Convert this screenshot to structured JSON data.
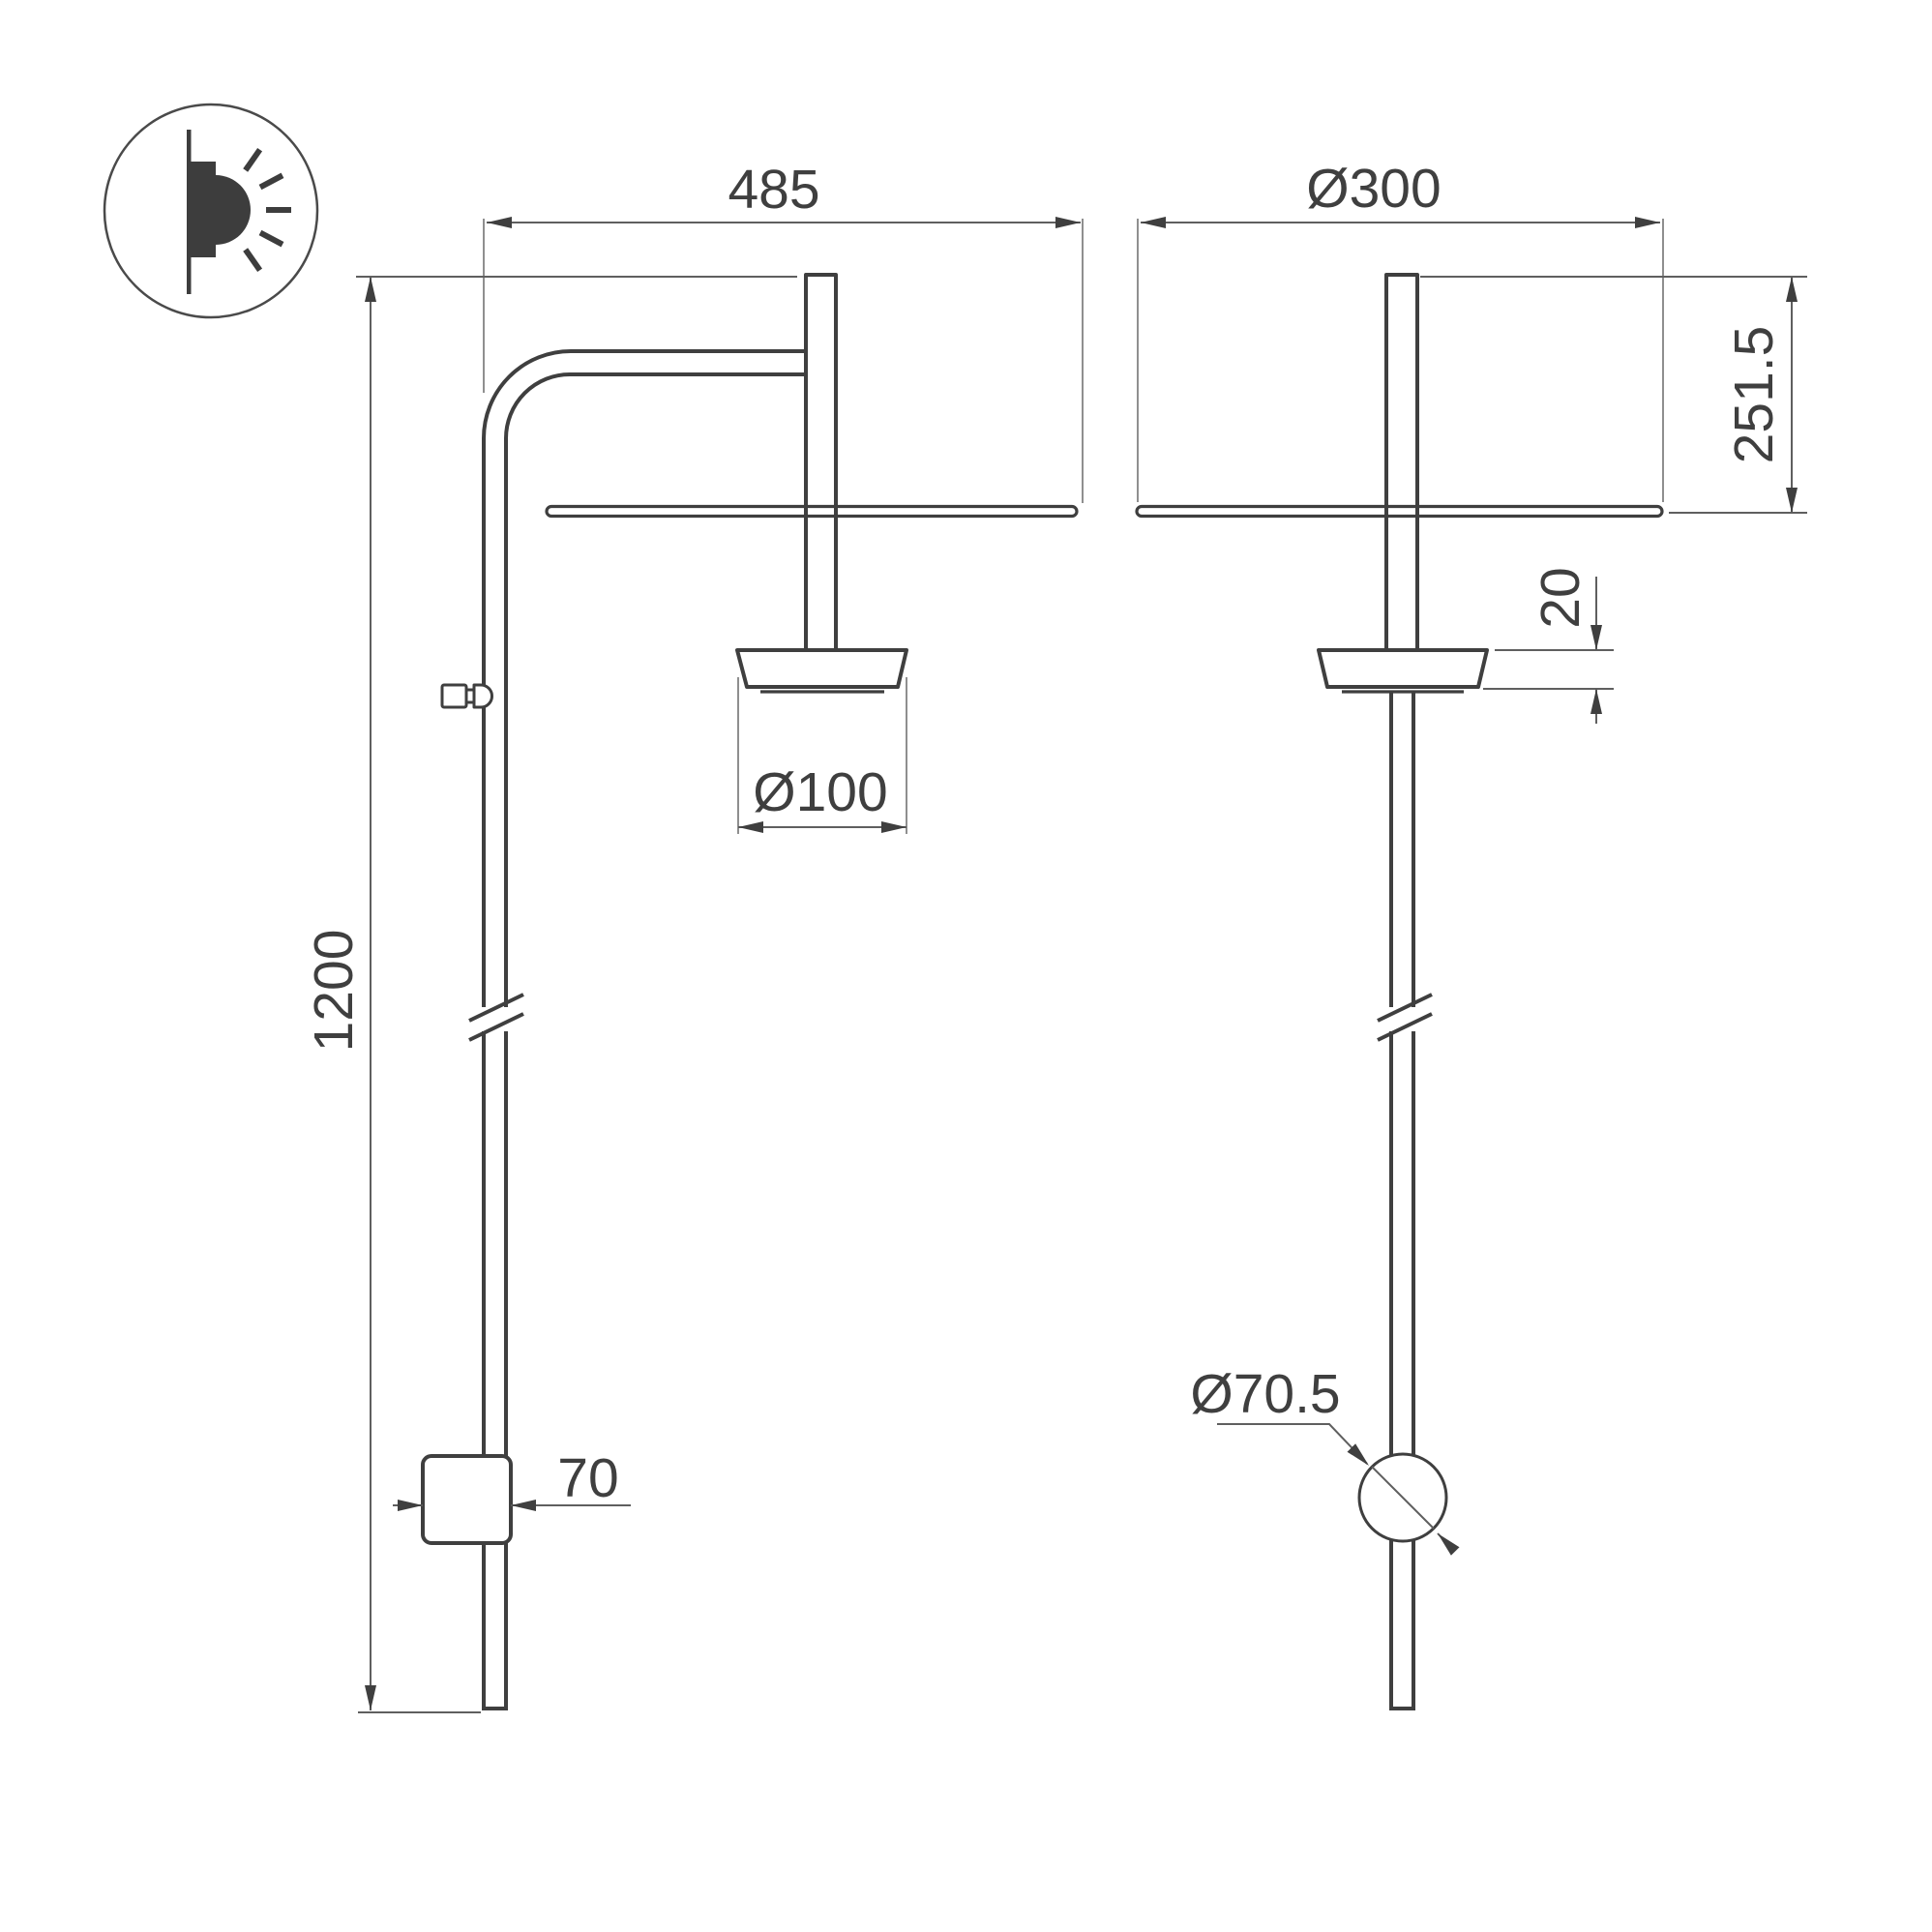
{
  "page": {
    "background": "#ffffff"
  },
  "icon": {
    "name": "wall-mounted-light",
    "color": "#3d3d3d"
  },
  "dimensions": {
    "arm_depth": "485",
    "shade_diameter": "Ø300",
    "head_height": "251.5",
    "cup_offset": "20",
    "cup_diameter": "Ø100",
    "fixture_height": "1200",
    "mount_width": "70",
    "switch_diameter": "Ø70.5"
  },
  "colors": {
    "object_line": "#3f3f3f",
    "dimension_line": "#5f5f5f",
    "extension_line": "#8f8f8f",
    "label_text": "#3f3f3f"
  }
}
